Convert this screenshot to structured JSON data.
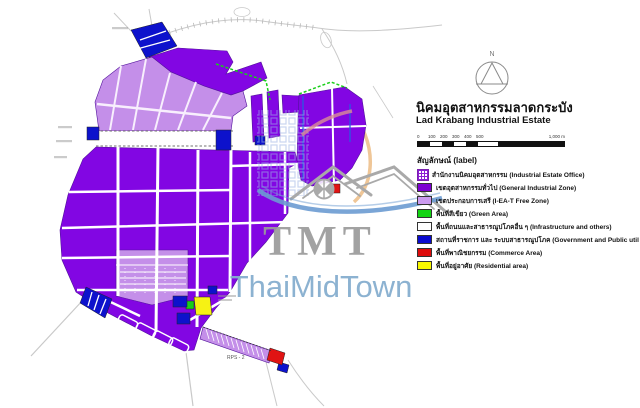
{
  "title": {
    "thai": "นิคมอุตสาหกรรมลาดกระบัง",
    "english": "Lad Krabang Industrial Estate"
  },
  "compass": {
    "north_label": "N"
  },
  "scale_bar": {
    "ticks": [
      "0",
      "100",
      "200",
      "300",
      "400",
      "500"
    ],
    "end_label": "1,000 m"
  },
  "legend": {
    "heading": "สัญลักษณ์ (label)",
    "items": [
      {
        "name": "industrial-estate-office",
        "label": "สำนักงานนิคมอุตสาหกรรม (Industrial Estate Office)",
        "color": "#8c1fd4"
      },
      {
        "name": "general-industrial-zone",
        "label": "เขตอุตสาหกรรมทั่วไป (General Industrial Zone)",
        "color": "#7d00d2"
      },
      {
        "name": "free-zone",
        "label": "เขตประกอบการเสรี (I-EA-T Free Zone)",
        "color": "#cb9af0"
      },
      {
        "name": "green-area",
        "label": "พื้นที่สีเขียว (Green Area)",
        "color": "#12d412"
      },
      {
        "name": "infrastructure",
        "label": "พื้นที่ถนนและสาธารณูปโภคอื่น ๆ (Infrastructure and others)",
        "color": "#ffffff"
      },
      {
        "name": "government-public-utility",
        "label": "สถานที่ราชการ และ ระบบสาธารณูปโภค (Government and Public utility)",
        "color": "#0b0bd0"
      },
      {
        "name": "commerce-area",
        "label": "พื้นที่พาณิชยกรรม (Commerce Area)",
        "color": "#de0c0c"
      },
      {
        "name": "residential-area",
        "label": "พื้นที่อยู่อาศัย (Residential area)",
        "color": "#f8f800"
      }
    ]
  },
  "watermark": {
    "brand_short": "TMT",
    "brand_full": "ThaiMidTown"
  },
  "map": {
    "strip_label": "RPS - 2"
  },
  "colors": {
    "general_industrial": "#8206e3",
    "free_zone": "#c48fe9",
    "green_area": "#19cf19",
    "government_blue": "#0d12cc",
    "commerce_red": "#e01313",
    "residential_yellow": "#f6f214",
    "road_white": "#ffffff",
    "watermark_gray": "#9b9b9b",
    "watermark_blue": "#86aecf",
    "swoosh_blue": "#6b9bd2"
  }
}
